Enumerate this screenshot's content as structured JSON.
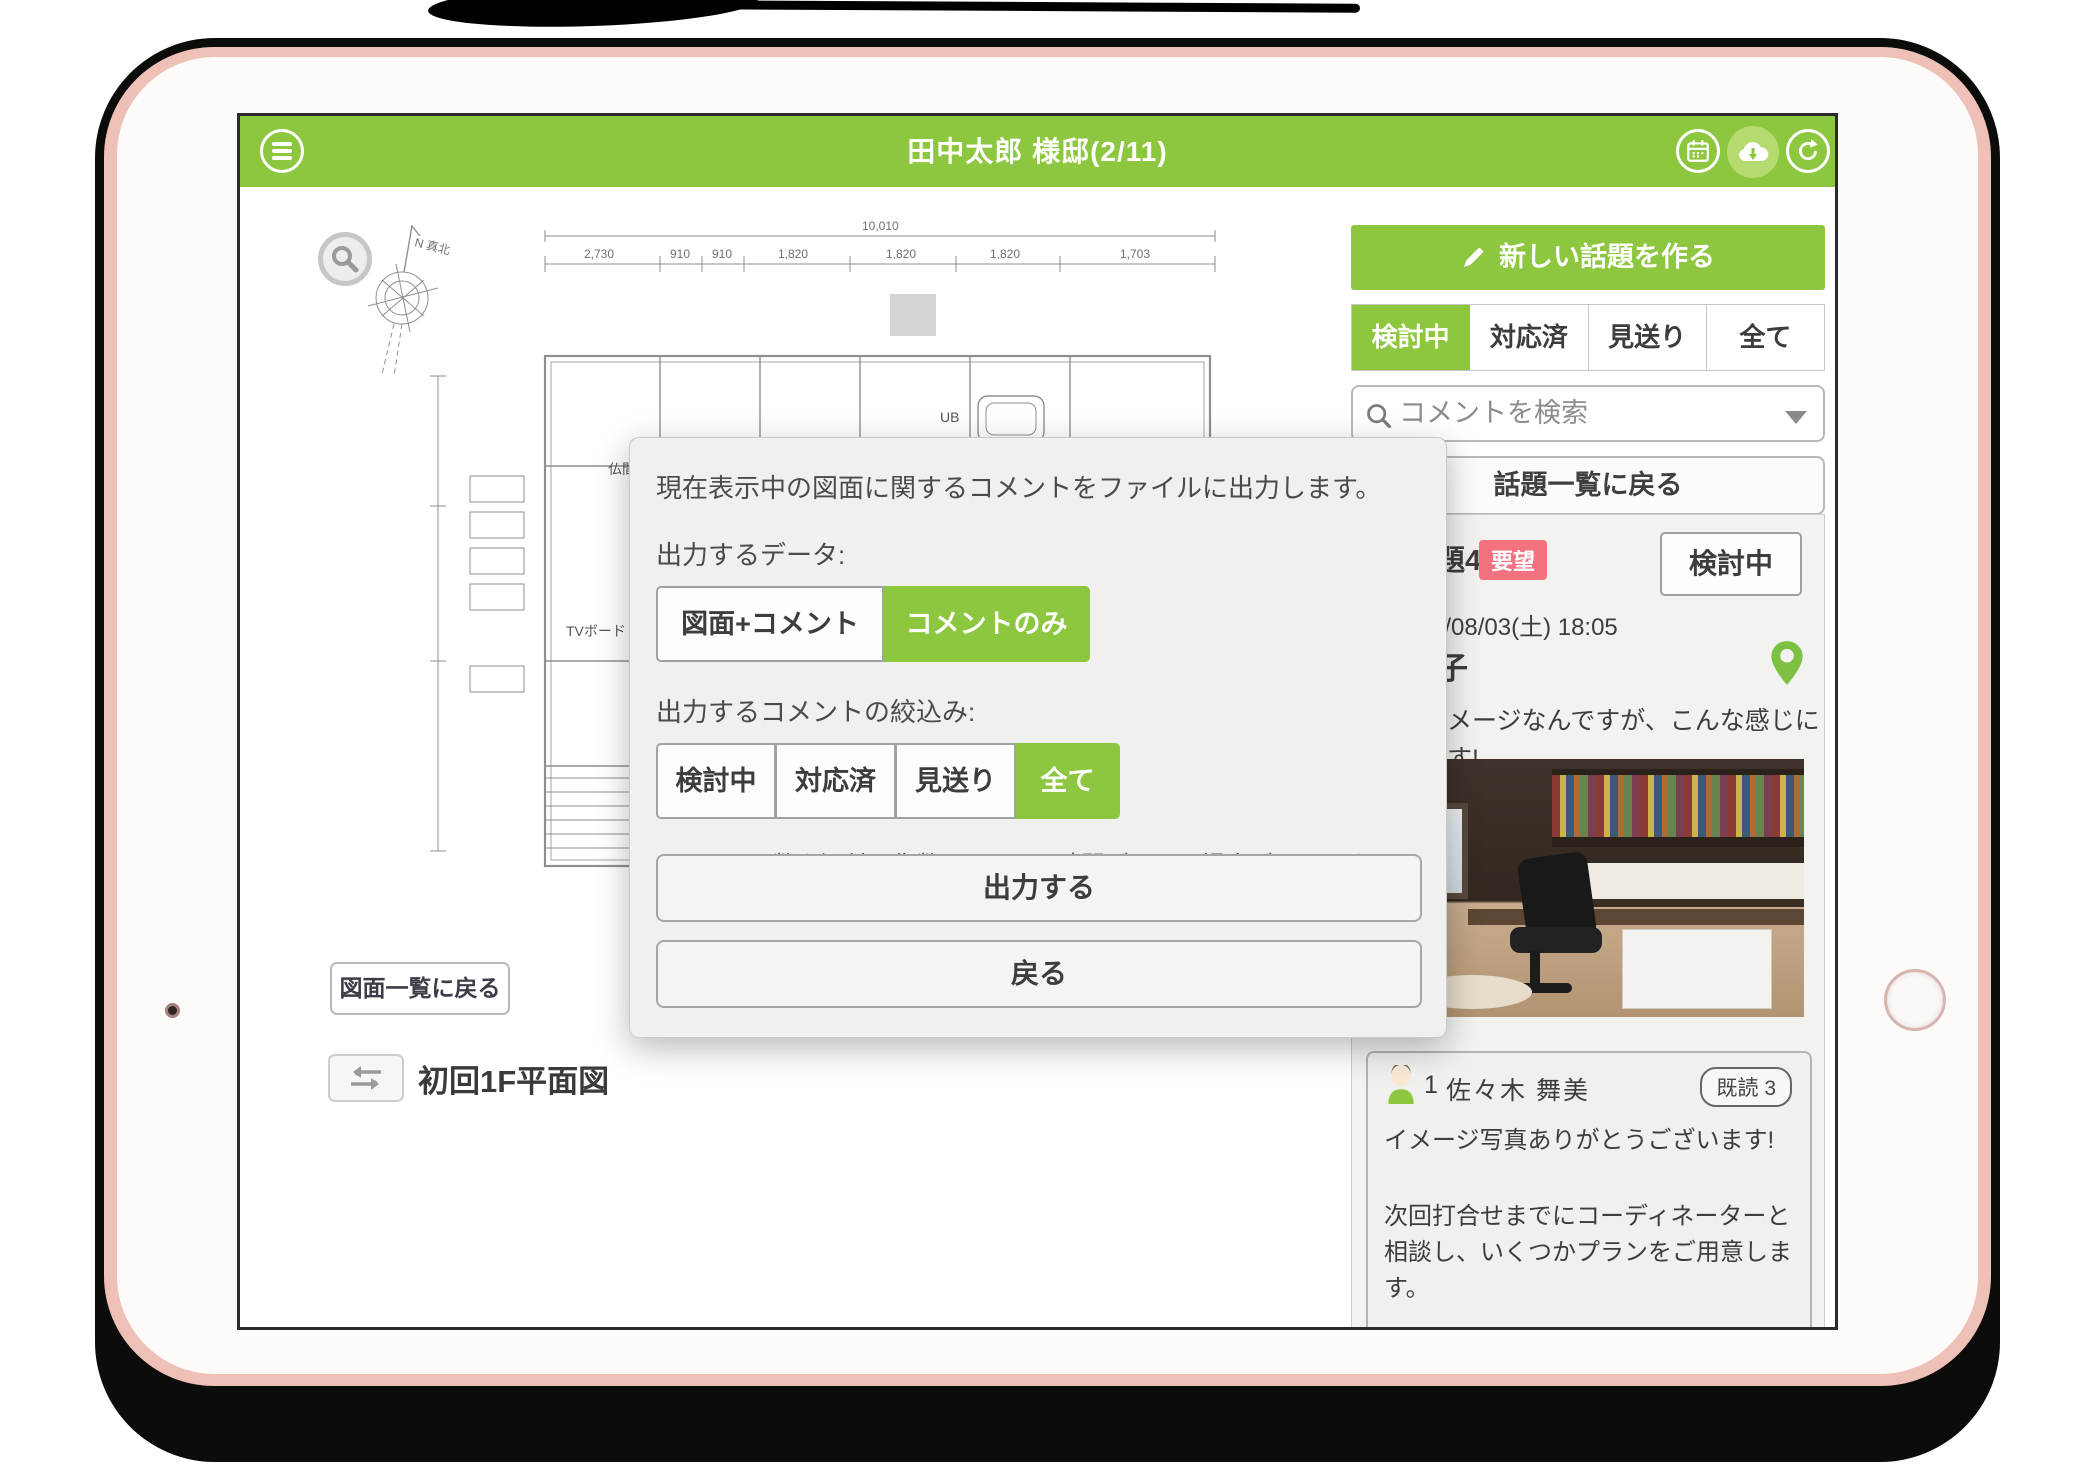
{
  "header": {
    "title": "田中太郎 様邸(2/11)"
  },
  "drawing": {
    "back_button": "図面一覧に戻る",
    "title": "初回1F平面図",
    "plan": {
      "compass_label": "N 真北",
      "dim_total": "10,010",
      "dims": [
        "2,730",
        "910",
        "910",
        "1,820",
        "1,820",
        "1,820",
        "1,703"
      ],
      "labels": [
        "仏間",
        "押入",
        "パントリー",
        "洗面脱衣室",
        "UB",
        "TVボード"
      ]
    }
  },
  "modal": {
    "description": "現在表示中の図面に関するコメントをファイルに出力します。",
    "data_label": "出力するデータ:",
    "data_options": [
      {
        "label": "図面+コメント",
        "selected": false
      },
      {
        "label": "コメントのみ",
        "selected": true
      }
    ],
    "filter_label": "出力するコメントの絞込み:",
    "filter_options": [
      {
        "label": "検討中",
        "selected": false
      },
      {
        "label": "対応済",
        "selected": false
      },
      {
        "label": "見送り",
        "selected": false
      },
      {
        "label": "全て",
        "selected": true
      }
    ],
    "note": "※コメント数や添付画像数によって、時間がかかる場合があります。",
    "export_button": "出力する",
    "back_button": "戻る"
  },
  "sidebar": {
    "new_topic_button": "新しい話題を作る",
    "tabs": [
      {
        "label": "検討中",
        "active": true
      },
      {
        "label": "対応済",
        "active": false
      },
      {
        "label": "見送り",
        "active": false
      },
      {
        "label": "全て",
        "active": false
      }
    ],
    "search_placeholder": "コメントを検索",
    "back_to_topics": "話題一覧に戻る",
    "topic": {
      "number_fragment": "題4",
      "badge": "要望",
      "status": "検討中",
      "date_fragment": "4/08/03(土) 18:05",
      "title_fragment": "子",
      "body_fragment_1": "メージなんですが、こんな感じに",
      "body_fragment_2": "す!"
    },
    "comment": {
      "number": "1",
      "author": "佐々木 舞美",
      "read_badge": "既読 3",
      "paragraphs": [
        "イメージ写真ありがとうございます!",
        "次回打合せまでにコーディネーターと相談し、いくつかプランをご用意します。",
        "次回打合せまでにお時間ありますので、ご質問・ご要望等ありましたら、お気軽にご連絡ください!"
      ]
    }
  },
  "colors": {
    "accent_green": "#8dc63f",
    "accent_green_light": "#b5da70",
    "badge_red": "#f2737f",
    "pin_green": "#7cc142",
    "panel_bg": "#f2f2f0"
  }
}
